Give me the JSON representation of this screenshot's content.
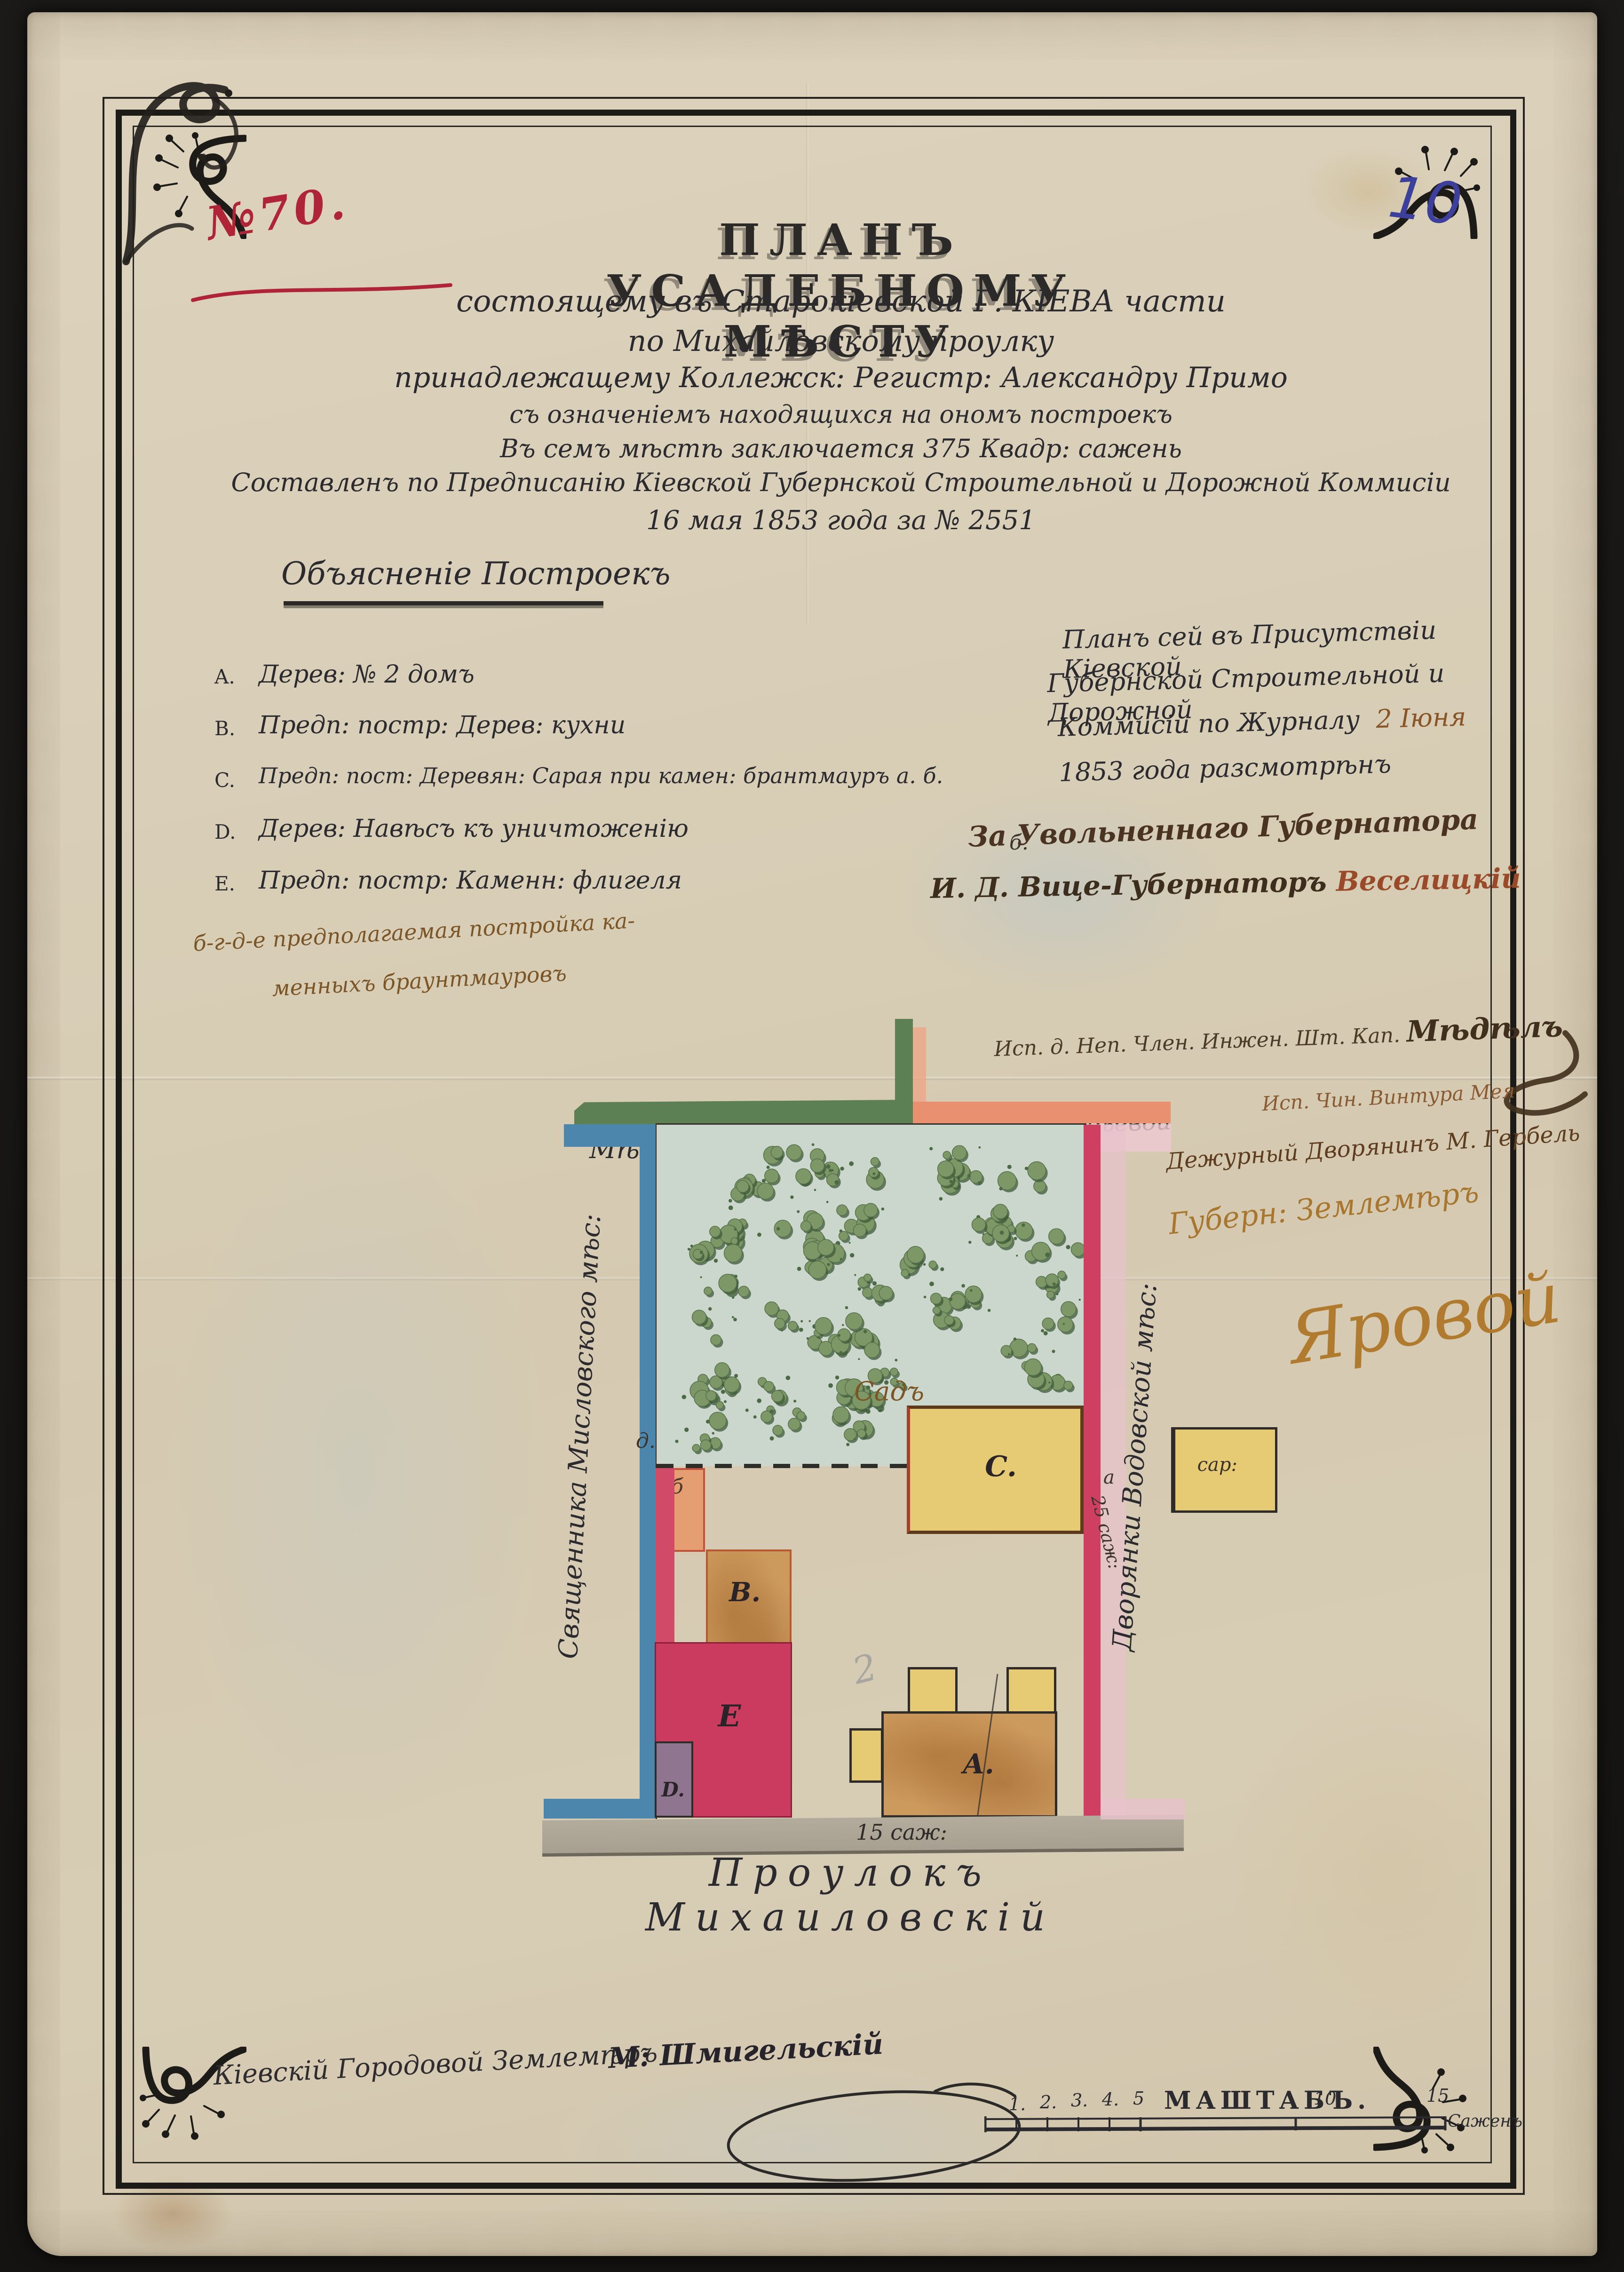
{
  "doc": {
    "file_number": "№70.",
    "page_number": "10",
    "title": "ПЛАНЪ  УСАДЕБНОМУ  МѢСТУ",
    "subtitle": [
      "состоящему въ Старокіевской  Г. КІЕВА части",
      "по Михайловскому проулку",
      "принадлежащему Коллежск: Регистр: Александру Примо",
      "съ означеніемъ находящихся на ономъ построекъ",
      "Въ семъ мѣстѣ заключается 375    Квадр: сажень",
      "Составленъ по Предписанію Кіевской Губернской Строительной и Дорожной Коммисіи",
      "16 мая 1853 года за № 2551"
    ]
  },
  "legend": {
    "heading": "Объясненіе Построекъ",
    "items": [
      {
        "letter": "A.",
        "text": "Дерев: № 2 домъ"
      },
      {
        "letter": "B.",
        "text": "Предп: постр: Дерев: кухни"
      },
      {
        "letter": "C.",
        "text": "Предп: пост: Деревян: Сарая при камен: брантмауръ а. б."
      },
      {
        "letter": "D.",
        "text": "Дерев: Навѣсъ къ уничтоженію"
      },
      {
        "letter": "E.",
        "text": "Предп: постр: Каменн: флигеля"
      }
    ],
    "stray_b": "б.",
    "note_line1": "б-г-д-е предполагаемая постройка ка-",
    "note_line2": "менныхъ браунтмауровъ"
  },
  "approval": {
    "line1": "Планъ сей въ Присутствіи Кіевской",
    "line2": "Губернской Строительной и Дорожной",
    "line3": "Коммисіи по Журналу",
    "date": "2 Іюня",
    "line4": "1853 года разсмотрѣнъ",
    "deputy_line": "За Увольненнаго Губернатора",
    "vice_title": "И. Д.  Вице-Губернаторъ",
    "vice_signature": "Веселицкій",
    "member_line": "Исп. д. Неп. Член. Инжен. Шт. Кап.",
    "member_signature": "Мѣдѣлъ",
    "member_line2": "Исп. Чин. Винтура Мея",
    "duty_line": "Дежурный Дворянинъ М. Гербель",
    "surveyor_title": "Губерн: Землемѣръ",
    "surveyor_signature": "Яровой"
  },
  "plan": {
    "neighbor_top_left": "Мѣсто Диковского",
    "neighbor_top_right": "Ст: сов: Корнѣевой",
    "neighbor_left": "Священника Мисловского мѣс:",
    "neighbor_right": "Дворянки Водовской мѣс:",
    "garden_label": "Садъ",
    "street_label": "Проулокъ Михаиловскій",
    "width_dim": "15 саж:",
    "depth_dim": "25 саж:",
    "shed_label": "сар:",
    "letters": {
      "A": "А.",
      "B": "B.",
      "C": "C.",
      "D": "D.",
      "E": "E"
    },
    "markers": {
      "a": "а",
      "b": "б",
      "g": "г.",
      "d": "д.",
      "e": "е",
      "pencil": "2"
    }
  },
  "scalebar": {
    "ticks": [
      "1.",
      "2.",
      "3.",
      "4.",
      "5"
    ],
    "label": "МАШТАБЪ.",
    "ten": "10",
    "fifteen": "15",
    "unit": "Саженъ"
  },
  "footer": {
    "surveyor_title": "Кіевскій Городовой Землемѣръ",
    "surveyor_name": "М: Шмигельскій"
  },
  "colors": {
    "red_ink": "#b02437",
    "blue_pencil": "#3c3f9b",
    "black_ink": "#2b2a2e",
    "brown_ink": "#6d4a22",
    "light_brown": "#a9762e",
    "green_band": "#5c7f53",
    "blue_band": "#4c86ad",
    "salmon": "#e89070",
    "crimson": "#c73a5e",
    "pink_wash": "#e4b6c3",
    "yellow": "#e6ca74",
    "tan": "#c28e50",
    "gray_street": "#a79f90",
    "garden": "#cbd6cc"
  }
}
